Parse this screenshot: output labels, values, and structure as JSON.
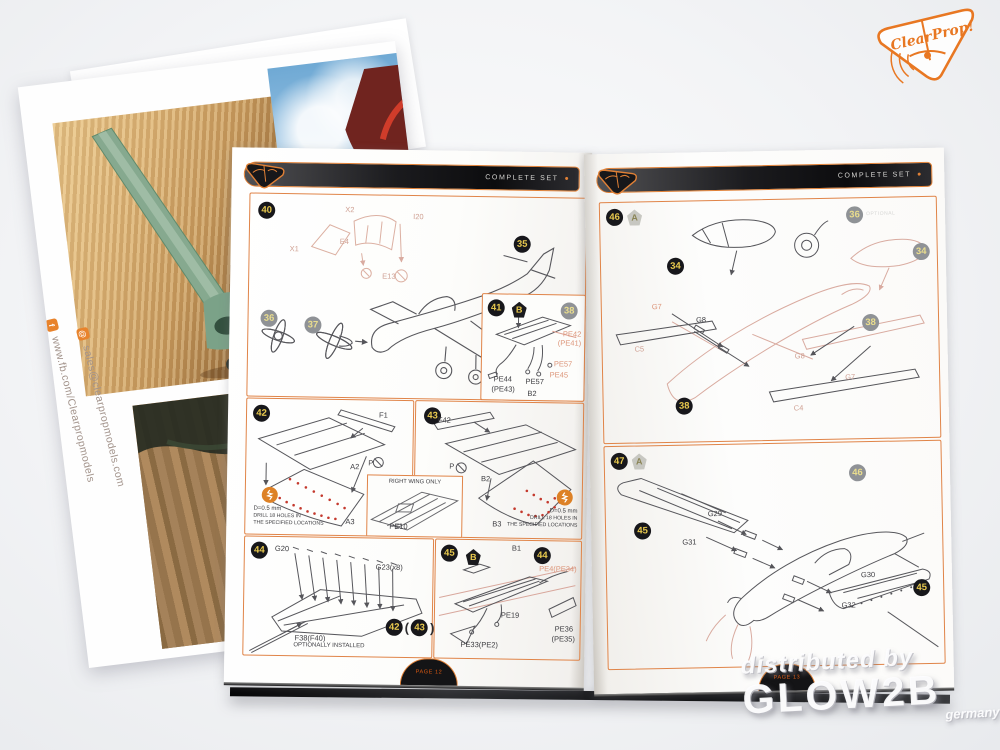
{
  "brand": {
    "word1": "Clear",
    "word2": "Prop!"
  },
  "header": {
    "label": "COMPLETE SET",
    "dot": "●"
  },
  "watermark": {
    "l1": "distributed by",
    "l2": "GLOW2B",
    "l3": "germany"
  },
  "poster": {
    "email": "sales@clearpropmodels.com",
    "fb": "www.fb.com/Clearpropmodels",
    "mail_glyph": "@",
    "fb_glyph": "f"
  },
  "footers": {
    "left": "PAGE 12",
    "right": "PAGE 13"
  },
  "steps": {
    "s40": {
      "num": "40",
      "ref36": "36",
      "ref37": "37",
      "ref35": "35",
      "x1": "X1",
      "x2": "X2",
      "e4": "E4",
      "e13": "E13",
      "i20": "I20"
    },
    "s41": {
      "num": "41",
      "variant": "B",
      "ref38": "38",
      "pe42": "PE42",
      "pe41": "(PE41)",
      "pe57a": "PE57",
      "pe45": "PE45",
      "pe44": "PE44",
      "pe43": "(PE43)",
      "pe57b": "PE57",
      "b2": "B2"
    },
    "s42": {
      "num": "42",
      "f1": "F1",
      "a2": "A2",
      "a3": "A3",
      "p": "P",
      "drill_d": "D=0.5 mm",
      "drill1": "DRILL 18 HOLES IN",
      "drill2": "THE SPECIFIED LOCATIONS"
    },
    "s43": {
      "num": "43",
      "f42": "F42",
      "b2": "B2",
      "b3": "B3",
      "p": "P",
      "drill_d": "D=0.5 mm",
      "drill1": "DRILL 18 HOLES IN",
      "drill2": "THE SPECIFIED LOCATIONS",
      "inset_title": "RIGHT WING ONLY",
      "pe10": "PE10"
    },
    "s44": {
      "num": "44",
      "g20": "G20",
      "g23": "G23(x8)",
      "f38": "F38(F40)",
      "note": "OPTIONALLY INSTALLED",
      "ref42": "42",
      "po": "(",
      "ref43": "43",
      "pc": ")"
    },
    "s45": {
      "num": "45",
      "variant": "B",
      "ref44": "44",
      "b1": "B1",
      "pe4": "PE4(PE34)",
      "pe19": "PE19",
      "pe36": "PE36",
      "pe35": "(PE35)",
      "pe33": "PE33(PE2)"
    },
    "s46": {
      "num": "46",
      "variant": "A",
      "ref34a": "34",
      "ref36": "36",
      "note": "OPTIONAL",
      "ref34b": "34",
      "ref38a": "38",
      "ref38b": "38",
      "g7a": "G7",
      "g8a": "G8",
      "c5": "C5",
      "g8b": "G8",
      "c4": "C4",
      "g7b": "G7"
    },
    "s47": {
      "num": "47",
      "variant": "A",
      "ref45a": "45",
      "g29": "G29",
      "g31": "G31",
      "ref46": "46",
      "g30": "G30",
      "g32": "G32",
      "ref45b": "45"
    }
  }
}
